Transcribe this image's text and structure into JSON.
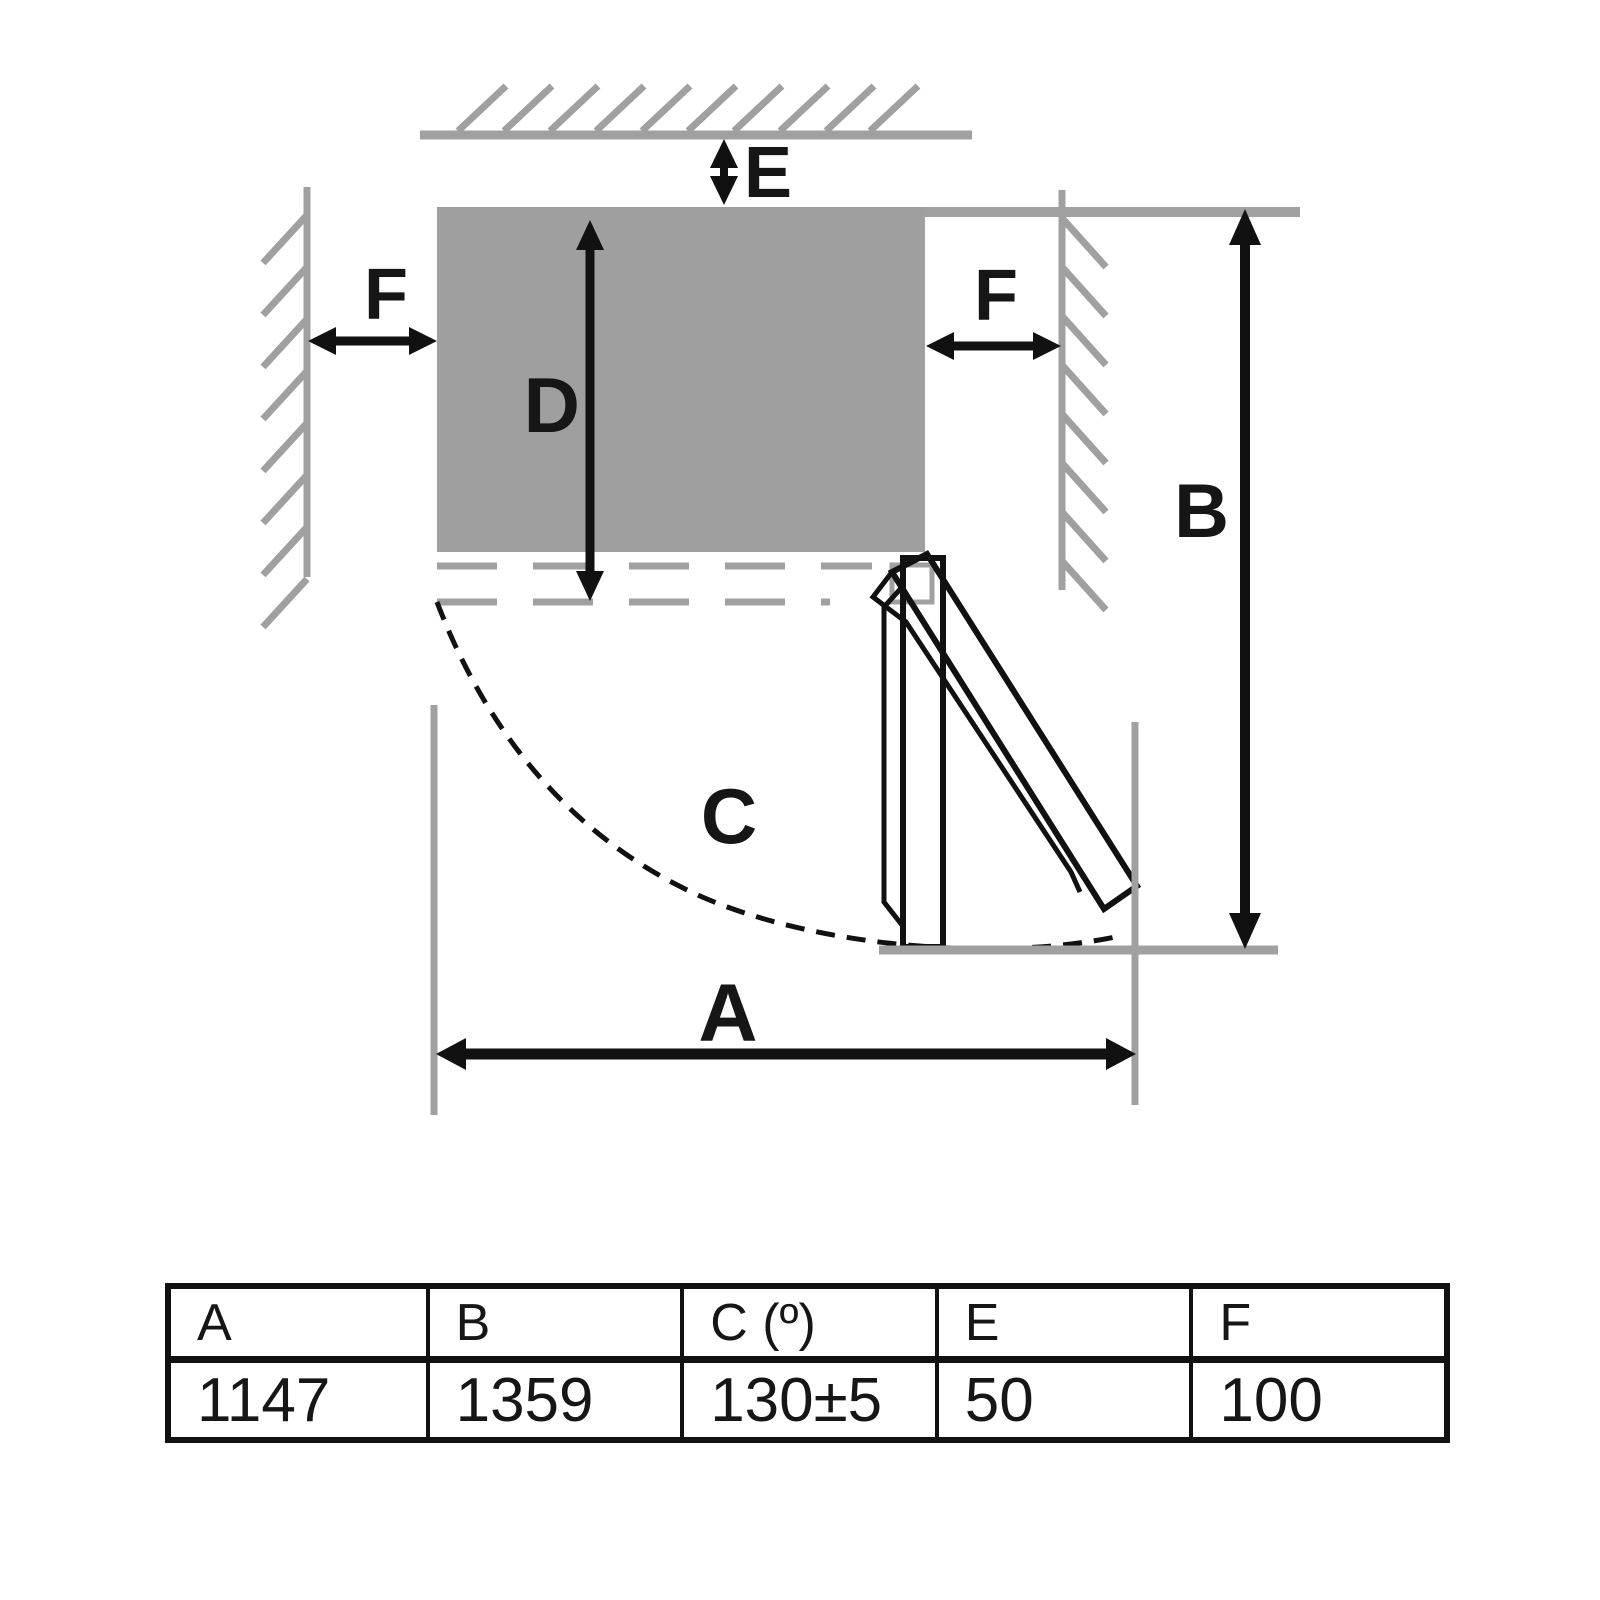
{
  "diagram": {
    "labels": {
      "a": "A",
      "b": "B",
      "c": "C",
      "d": "D",
      "e": "E",
      "f_left": "F",
      "f_right": "F"
    }
  },
  "table": {
    "headers": [
      "A",
      "B",
      "C (º)",
      "E",
      "F"
    ],
    "values": [
      "1147",
      "1359",
      "130±5",
      "50",
      "100"
    ]
  },
  "colors": {
    "background": "#ffffff",
    "wall_gray": "#a0a0a0",
    "cabinet_fill": "#9f9f9f",
    "line_black": "#111111",
    "text": "#161616"
  }
}
